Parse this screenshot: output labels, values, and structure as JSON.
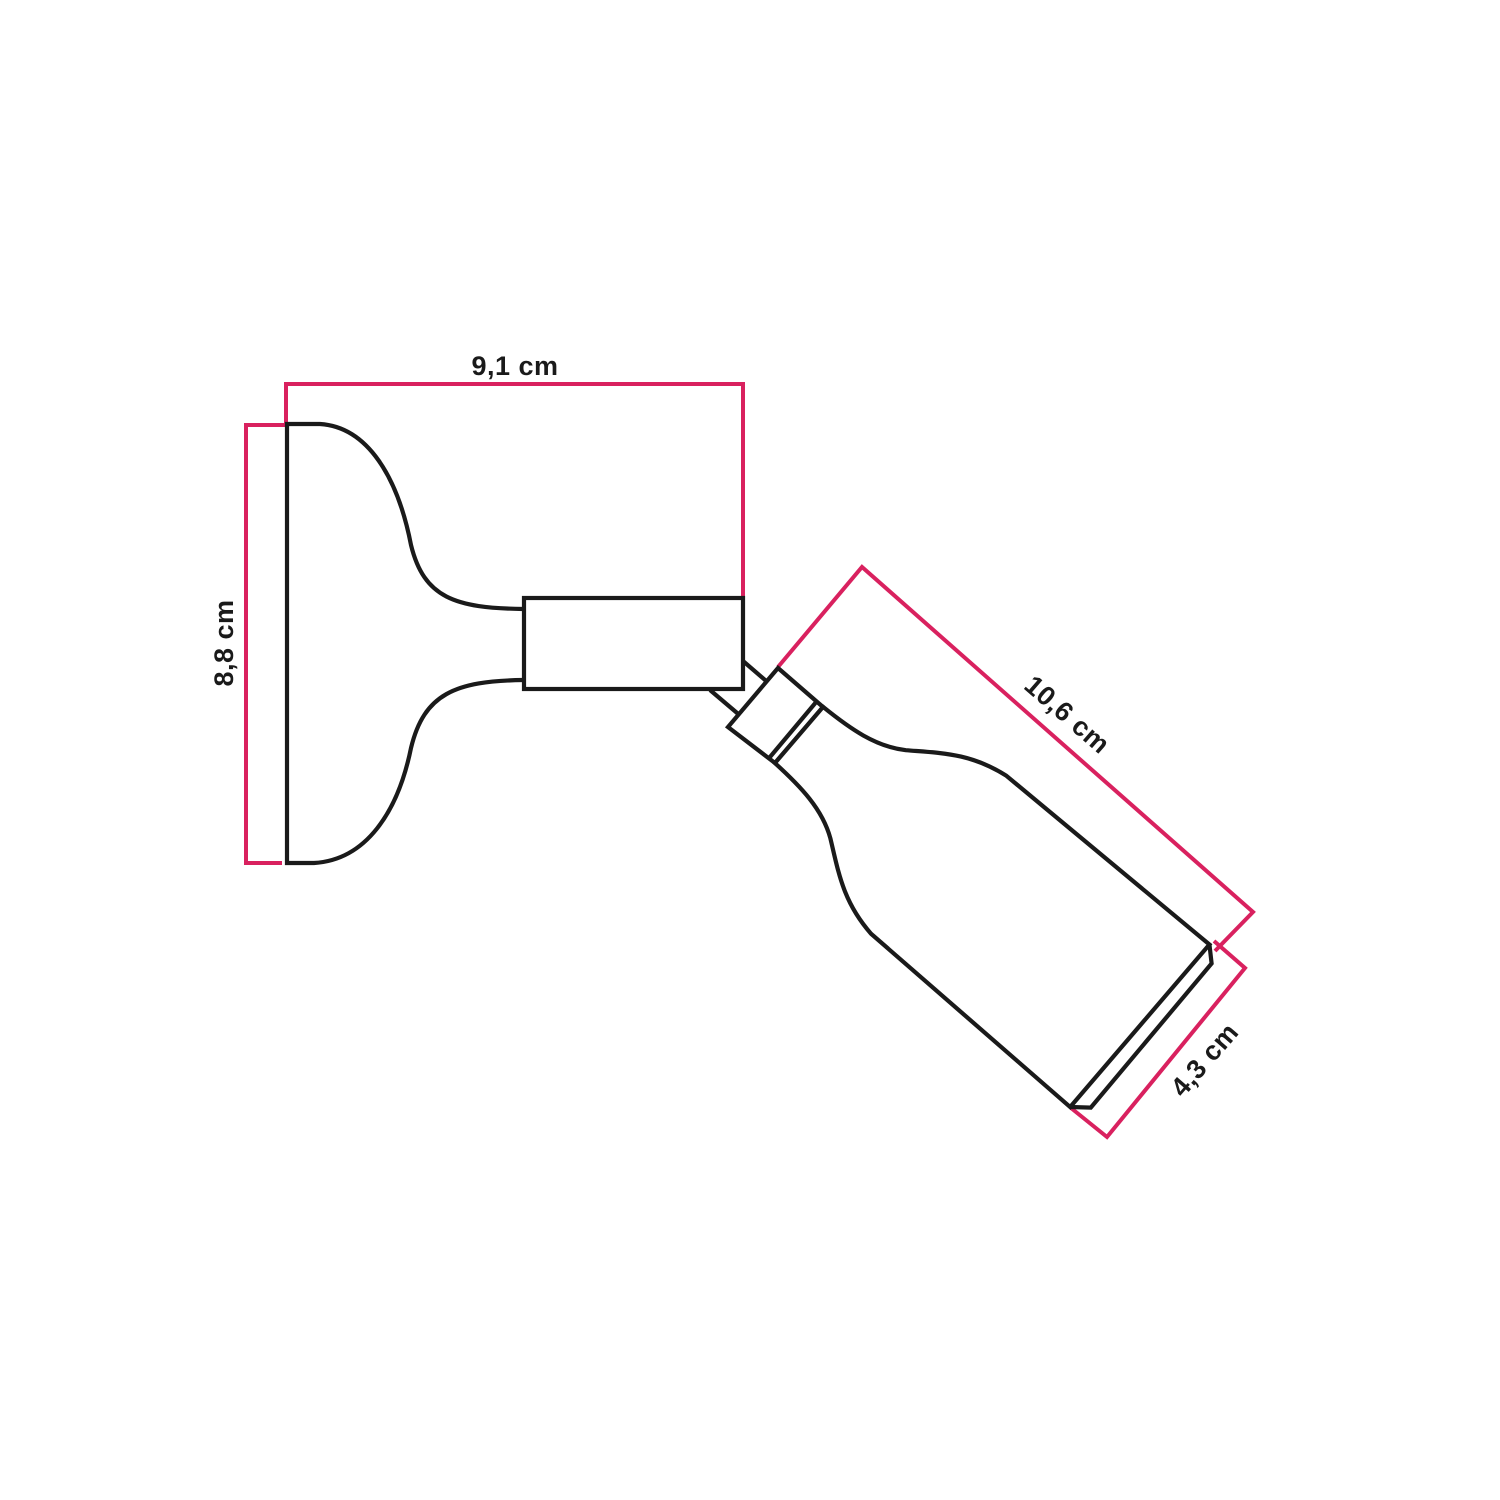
{
  "diagram": {
    "labels": {
      "width": "9,1 cm",
      "height": "8,8 cm",
      "length": "10,6 cm",
      "diameter": "4,3 cm"
    }
  },
  "colors": {
    "dimension_accent": "#D9215F",
    "outline": "#1A1A1A",
    "background": "#FFFFFF"
  }
}
